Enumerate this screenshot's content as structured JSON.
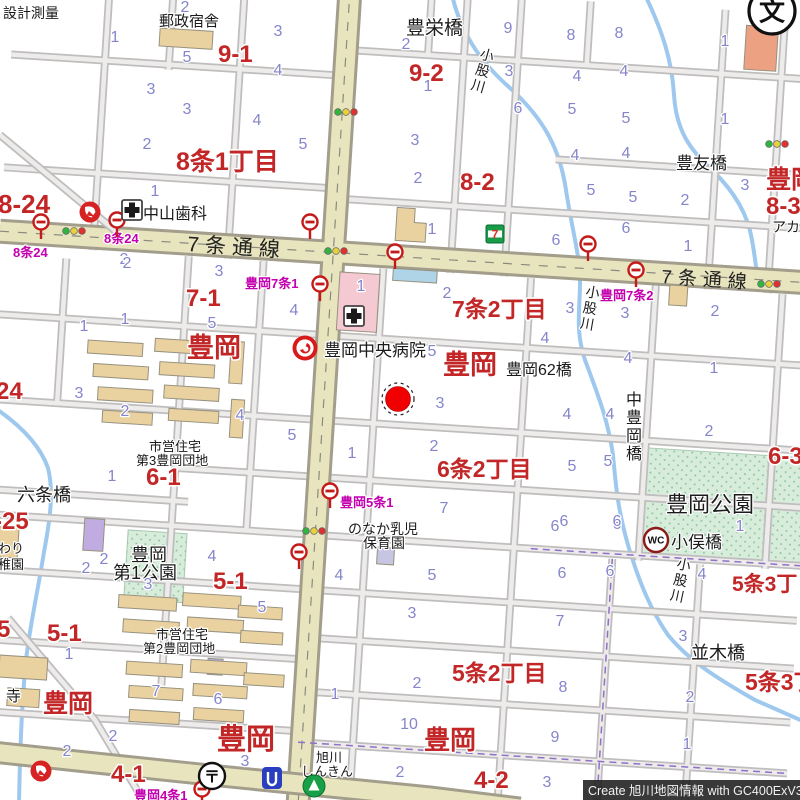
{
  "map": {
    "watermark": "Create 旭川地図情報 with GC400ExV3",
    "colors": {
      "district_label": "#C22626",
      "block_number": "#8585CC",
      "busstop_label": "#C400AE",
      "facility_label": "#1A1A1A",
      "main_road": "#E8E5BE",
      "minor_road": "#EDECEA",
      "river": "#9EC8EE",
      "park": "#D8ECDC",
      "building_tan": "#EAD2A0",
      "building_pink": "#F4C9D2",
      "marker_red": "#F00000"
    },
    "district_labels": [
      {
        "t": "9-1",
        "x": 218,
        "y": 62,
        "s": 24
      },
      {
        "t": "9-2",
        "x": 409,
        "y": 81,
        "s": 24
      },
      {
        "t": "8-24",
        "x": -2,
        "y": 213,
        "s": 26
      },
      {
        "t": "8条1丁目",
        "x": 176,
        "y": 170,
        "s": 25
      },
      {
        "t": "8-2",
        "x": 460,
        "y": 190,
        "s": 24
      },
      {
        "t": "豊岡",
        "x": 766,
        "y": 188,
        "s": 25
      },
      {
        "t": "8-3",
        "x": 766,
        "y": 214,
        "s": 24
      },
      {
        "t": "7-1",
        "x": 186,
        "y": 306,
        "s": 24
      },
      {
        "t": "7条2丁目",
        "x": 452,
        "y": 317,
        "s": 23
      },
      {
        "t": "豊岡",
        "x": 187,
        "y": 357,
        "s": 27
      },
      {
        "t": "豊岡",
        "x": 443,
        "y": 374,
        "s": 27
      },
      {
        "t": "24",
        "x": -4,
        "y": 399,
        "s": 24
      },
      {
        "t": "6-1",
        "x": 146,
        "y": 485,
        "s": 24
      },
      {
        "t": "6条2丁目",
        "x": 437,
        "y": 477,
        "s": 23
      },
      {
        "t": "6-3",
        "x": 768,
        "y": 464,
        "s": 24
      },
      {
        "t": "-25",
        "x": -6,
        "y": 529,
        "s": 24
      },
      {
        "t": "5-1",
        "x": 213,
        "y": 589,
        "s": 24
      },
      {
        "t": "5条3丁目",
        "x": 732,
        "y": 591,
        "s": 21
      },
      {
        "t": "5",
        "x": -3,
        "y": 637,
        "s": 24
      },
      {
        "t": "5-1",
        "x": 47,
        "y": 641,
        "s": 24
      },
      {
        "t": "5条2丁目",
        "x": 452,
        "y": 681,
        "s": 23
      },
      {
        "t": "5条3丁目",
        "x": 745,
        "y": 690,
        "s": 23
      },
      {
        "t": "豊岡",
        "x": 43,
        "y": 712,
        "s": 25
      },
      {
        "t": "豊岡",
        "x": 217,
        "y": 749,
        "s": 29
      },
      {
        "t": "豊岡",
        "x": 424,
        "y": 749,
        "s": 26
      },
      {
        "t": "4-1",
        "x": 111,
        "y": 782,
        "s": 24
      },
      {
        "t": "4-2",
        "x": 474,
        "y": 788,
        "s": 24
      }
    ],
    "facility_labels": [
      {
        "t": "設計測量",
        "x": 3,
        "y": 18,
        "s": 14
      },
      {
        "t": "郵政宿舎",
        "x": 159,
        "y": 26,
        "s": 15
      },
      {
        "t": "豊栄橋",
        "x": 406,
        "y": 34,
        "s": 19
      },
      {
        "t": "豊友橋",
        "x": 676,
        "y": 169,
        "s": 17
      },
      {
        "t": "アカ",
        "x": 772,
        "y": 232,
        "s": 14
      },
      {
        "t": "中山歯科",
        "x": 143,
        "y": 219,
        "s": 16
      },
      {
        "t": "豊岡中央病院",
        "x": 324,
        "y": 356,
        "s": 17
      },
      {
        "t": "豊岡62橋",
        "x": 506,
        "y": 375,
        "s": 16
      },
      {
        "t": "市営住宅",
        "x": 149,
        "y": 451,
        "s": 13
      },
      {
        "t": "第3豊岡団地",
        "x": 136,
        "y": 465,
        "s": 13
      },
      {
        "t": "六条橋",
        "x": 17,
        "y": 501,
        "s": 18
      },
      {
        "t": "豊岡公園",
        "x": 666,
        "y": 512,
        "s": 22
      },
      {
        "t": "小俣橋",
        "x": 671,
        "y": 548,
        "s": 17
      },
      {
        "t": "わり",
        "x": -2,
        "y": 553,
        "s": 13
      },
      {
        "t": "稚園",
        "x": -2,
        "y": 569,
        "s": 13
      },
      {
        "t": "のなか乳児",
        "x": 348,
        "y": 534,
        "s": 14
      },
      {
        "t": "保育園",
        "x": 363,
        "y": 548,
        "s": 14
      },
      {
        "t": "豊岡",
        "x": 131,
        "y": 561,
        "s": 18
      },
      {
        "t": "第1公園",
        "x": 113,
        "y": 579,
        "s": 18
      },
      {
        "t": "市営住宅",
        "x": 156,
        "y": 639,
        "s": 13
      },
      {
        "t": "第2豊岡団地",
        "x": 143,
        "y": 653,
        "s": 13
      },
      {
        "t": "並木橋",
        "x": 691,
        "y": 659,
        "s": 18
      },
      {
        "t": "寺",
        "x": 6,
        "y": 701,
        "s": 15
      },
      {
        "t": "旭川",
        "x": 316,
        "y": 762,
        "s": 13
      },
      {
        "t": "しんきん",
        "x": 301,
        "y": 776,
        "s": 13
      }
    ],
    "vertical_labels": [
      {
        "t": "小股川",
        "x": 479,
        "y": 58,
        "s": 14,
        "rot": 16
      },
      {
        "t": "小股川",
        "x": 585,
        "y": 296,
        "s": 14,
        "rot": 10
      },
      {
        "t": "小股川",
        "x": 676,
        "y": 568,
        "s": 14,
        "rot": 12
      },
      {
        "t": "中豊岡橋",
        "x": 626,
        "y": 405,
        "s": 16,
        "rot": 0
      }
    ],
    "road_labels": [
      {
        "t": "7条通線",
        "x": 187,
        "y": 251,
        "s": 21,
        "rot": 3.6
      },
      {
        "t": "7条通線",
        "x": 661,
        "y": 283,
        "s": 19,
        "rot": 3.6
      }
    ],
    "busstop_labels": [
      {
        "t": "8条24",
        "x": 13,
        "y": 257
      },
      {
        "t": "8条24",
        "x": 104,
        "y": 243
      },
      {
        "t": "豊岡7条1",
        "x": 245,
        "y": 288
      },
      {
        "t": "豊岡7条2",
        "x": 600,
        "y": 300
      },
      {
        "t": "豊岡5条1",
        "x": 340,
        "y": 507
      },
      {
        "t": "豊岡4条1",
        "x": 134,
        "y": 800
      }
    ],
    "block_numbers": [
      {
        "n": "2",
        "x": 185,
        "y": 12
      },
      {
        "n": "1",
        "x": 115,
        "y": 42
      },
      {
        "n": "5",
        "x": 187,
        "y": 62
      },
      {
        "n": "3",
        "x": 151,
        "y": 94
      },
      {
        "n": "3",
        "x": 187,
        "y": 114
      },
      {
        "n": "4",
        "x": 257,
        "y": 125
      },
      {
        "n": "3",
        "x": 278,
        "y": 36
      },
      {
        "n": "4",
        "x": 278,
        "y": 75
      },
      {
        "n": "2",
        "x": 406,
        "y": 49
      },
      {
        "n": "9",
        "x": 508,
        "y": 33
      },
      {
        "n": "3",
        "x": 509,
        "y": 76
      },
      {
        "n": "6",
        "x": 518,
        "y": 113
      },
      {
        "n": "1",
        "x": 428,
        "y": 91
      },
      {
        "n": "8",
        "x": 571,
        "y": 40
      },
      {
        "n": "8",
        "x": 619,
        "y": 38
      },
      {
        "n": "4",
        "x": 577,
        "y": 81
      },
      {
        "n": "4",
        "x": 624,
        "y": 76
      },
      {
        "n": "5",
        "x": 572,
        "y": 114
      },
      {
        "n": "5",
        "x": 626,
        "y": 123
      },
      {
        "n": "1",
        "x": 725,
        "y": 46
      },
      {
        "n": "1",
        "x": 725,
        "y": 124
      },
      {
        "n": "2",
        "x": 147,
        "y": 149
      },
      {
        "n": "1",
        "x": 155,
        "y": 196
      },
      {
        "n": "2",
        "x": 124,
        "y": 264
      },
      {
        "n": "5",
        "x": 303,
        "y": 149
      },
      {
        "n": "3",
        "x": 415,
        "y": 145
      },
      {
        "n": "2",
        "x": 418,
        "y": 183
      },
      {
        "n": "1",
        "x": 432,
        "y": 234
      },
      {
        "n": "4",
        "x": 575,
        "y": 160
      },
      {
        "n": "4",
        "x": 626,
        "y": 158
      },
      {
        "n": "5",
        "x": 591,
        "y": 195
      },
      {
        "n": "5",
        "x": 633,
        "y": 202
      },
      {
        "n": "2",
        "x": 685,
        "y": 205
      },
      {
        "n": "3",
        "x": 745,
        "y": 190
      },
      {
        "n": "6",
        "x": 556,
        "y": 245
      },
      {
        "n": "6",
        "x": 626,
        "y": 233
      },
      {
        "n": "1",
        "x": 688,
        "y": 251
      },
      {
        "n": "2",
        "x": 127,
        "y": 268
      },
      {
        "n": "3",
        "x": 219,
        "y": 276
      },
      {
        "n": "1",
        "x": 84,
        "y": 331
      },
      {
        "n": "1",
        "x": 125,
        "y": 324
      },
      {
        "n": "5",
        "x": 212,
        "y": 328
      },
      {
        "n": "3",
        "x": 79,
        "y": 398
      },
      {
        "n": "1",
        "x": 361,
        "y": 291
      },
      {
        "n": "4",
        "x": 294,
        "y": 315
      },
      {
        "n": "2",
        "x": 447,
        "y": 298
      },
      {
        "n": "5",
        "x": 432,
        "y": 356
      },
      {
        "n": "3",
        "x": 570,
        "y": 313
      },
      {
        "n": "3",
        "x": 625,
        "y": 318
      },
      {
        "n": "4",
        "x": 545,
        "y": 343
      },
      {
        "n": "4",
        "x": 628,
        "y": 363
      },
      {
        "n": "2",
        "x": 715,
        "y": 316
      },
      {
        "n": "1",
        "x": 714,
        "y": 373
      },
      {
        "n": "2",
        "x": 125,
        "y": 416
      },
      {
        "n": "4",
        "x": 240,
        "y": 420
      },
      {
        "n": "1",
        "x": 112,
        "y": 481
      },
      {
        "n": "5",
        "x": 292,
        "y": 440
      },
      {
        "n": "1",
        "x": 352,
        "y": 458
      },
      {
        "n": "3",
        "x": 440,
        "y": 408
      },
      {
        "n": "2",
        "x": 434,
        "y": 451
      },
      {
        "n": "7",
        "x": 444,
        "y": 513
      },
      {
        "n": "4",
        "x": 567,
        "y": 419
      },
      {
        "n": "4",
        "x": 610,
        "y": 419
      },
      {
        "n": "5",
        "x": 572,
        "y": 471
      },
      {
        "n": "5",
        "x": 608,
        "y": 466
      },
      {
        "n": "6",
        "x": 555,
        "y": 531
      },
      {
        "n": "6",
        "x": 617,
        "y": 529
      },
      {
        "n": "2",
        "x": 709,
        "y": 436
      },
      {
        "n": "1",
        "x": 740,
        "y": 531
      },
      {
        "n": "2",
        "x": 104,
        "y": 564
      },
      {
        "n": "2",
        "x": 86,
        "y": 573
      },
      {
        "n": "3",
        "x": 148,
        "y": 589
      },
      {
        "n": "4",
        "x": 212,
        "y": 561
      },
      {
        "n": "5",
        "x": 262,
        "y": 612
      },
      {
        "n": "1",
        "x": 69,
        "y": 659
      },
      {
        "n": "4",
        "x": 339,
        "y": 580
      },
      {
        "n": "5",
        "x": 432,
        "y": 580
      },
      {
        "n": "3",
        "x": 412,
        "y": 618
      },
      {
        "n": "6",
        "x": 564,
        "y": 526
      },
      {
        "n": "6",
        "x": 617,
        "y": 526
      },
      {
        "n": "6",
        "x": 562,
        "y": 578
      },
      {
        "n": "6",
        "x": 610,
        "y": 576
      },
      {
        "n": "7",
        "x": 560,
        "y": 626
      },
      {
        "n": "4",
        "x": 702,
        "y": 579
      },
      {
        "n": "3",
        "x": 683,
        "y": 641
      },
      {
        "n": "2",
        "x": 67,
        "y": 756
      },
      {
        "n": "2",
        "x": 113,
        "y": 741
      },
      {
        "n": "7",
        "x": 156,
        "y": 696
      },
      {
        "n": "6",
        "x": 218,
        "y": 704
      },
      {
        "n": "3",
        "x": 245,
        "y": 766
      },
      {
        "n": "1",
        "x": 335,
        "y": 699
      },
      {
        "n": "2",
        "x": 417,
        "y": 688
      },
      {
        "n": "10",
        "x": 409,
        "y": 729
      },
      {
        "n": "2",
        "x": 400,
        "y": 777
      },
      {
        "n": "8",
        "x": 563,
        "y": 692
      },
      {
        "n": "9",
        "x": 555,
        "y": 742
      },
      {
        "n": "3",
        "x": 547,
        "y": 787
      },
      {
        "n": "2",
        "x": 690,
        "y": 702
      },
      {
        "n": "1",
        "x": 687,
        "y": 749
      }
    ],
    "icons": [
      {
        "type": "hydrant",
        "x": 90,
        "y": 212
      },
      {
        "type": "hydrant",
        "x": 41,
        "y": 771
      },
      {
        "type": "busstop",
        "x": 41,
        "y": 222
      },
      {
        "type": "busstop",
        "x": 117,
        "y": 220
      },
      {
        "type": "busstop",
        "x": 310,
        "y": 222
      },
      {
        "type": "busstop",
        "x": 395,
        "y": 252
      },
      {
        "type": "busstop",
        "x": 588,
        "y": 244
      },
      {
        "type": "busstop",
        "x": 636,
        "y": 270
      },
      {
        "type": "busstop",
        "x": 320,
        "y": 284
      },
      {
        "type": "busstop",
        "x": 330,
        "y": 491
      },
      {
        "type": "busstop",
        "x": 299,
        "y": 552
      },
      {
        "type": "busstop",
        "x": 202,
        "y": 789
      },
      {
        "type": "traffic",
        "x": 346,
        "y": 112
      },
      {
        "type": "traffic",
        "x": 74,
        "y": 231
      },
      {
        "type": "traffic",
        "x": 336,
        "y": 251
      },
      {
        "type": "traffic",
        "x": 777,
        "y": 144
      },
      {
        "type": "traffic",
        "x": 769,
        "y": 284
      },
      {
        "type": "traffic",
        "x": 314,
        "y": 531
      },
      {
        "type": "cross",
        "x": 132,
        "y": 210
      },
      {
        "type": "cross",
        "x": 354,
        "y": 316
      },
      {
        "type": "hospital",
        "x": 305,
        "y": 348
      },
      {
        "type": "school",
        "x": 772,
        "y": 11
      },
      {
        "type": "post",
        "x": 212,
        "y": 776
      },
      {
        "type": "wc",
        "x": 656,
        "y": 540
      },
      {
        "type": "seven",
        "x": 495,
        "y": 234
      },
      {
        "type": "bank",
        "x": 314,
        "y": 786
      },
      {
        "type": "blueicon",
        "x": 272,
        "y": 778
      },
      {
        "type": "marker",
        "x": 398,
        "y": 399
      }
    ],
    "icon_glyphs": {
      "school": "文",
      "post": "〒",
      "wc": "WC",
      "seven": "7"
    }
  }
}
